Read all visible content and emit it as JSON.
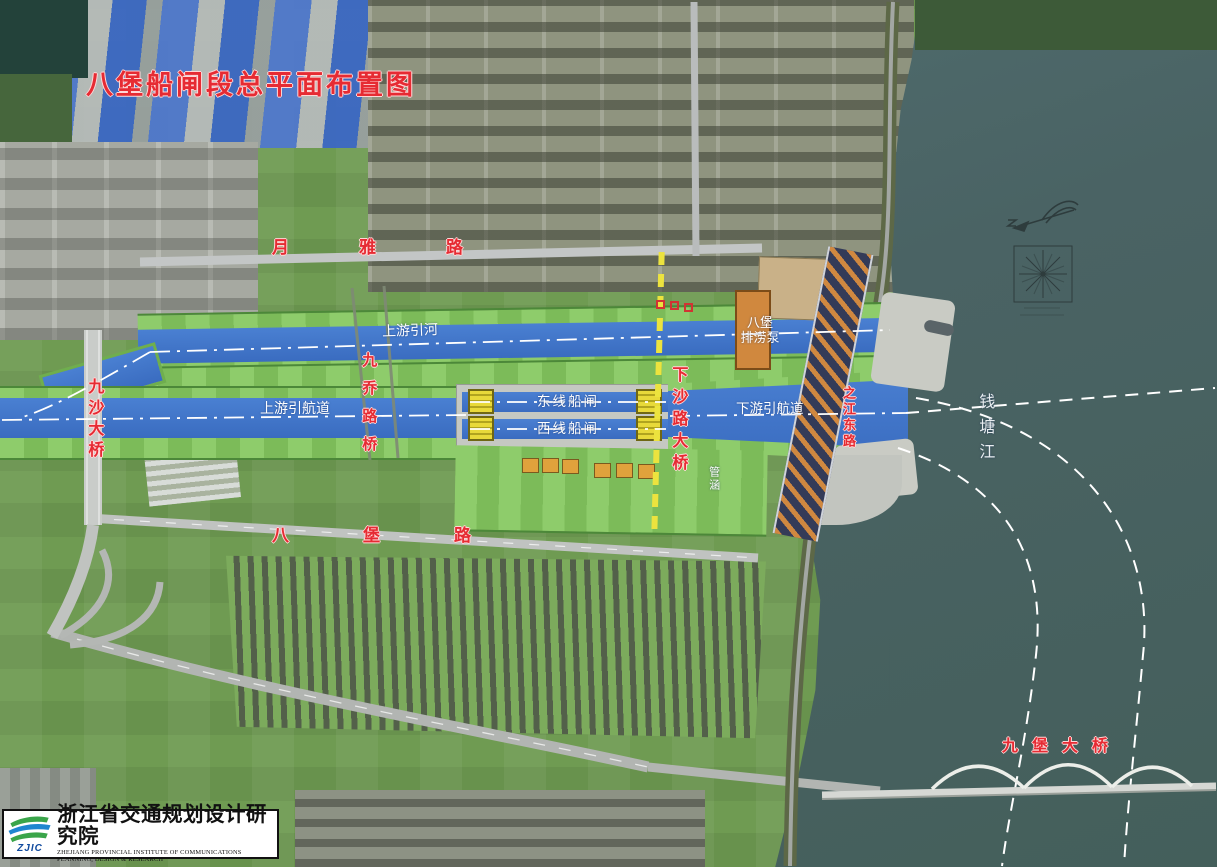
{
  "title": "八堡船闸段总平面布置图",
  "map_labels": {
    "yueya_road": "月雅路",
    "jiusha_bridge": "九沙大桥",
    "jiuqiao_bridge": "九乔路桥",
    "upstream_river": "上游引河",
    "upstream_channel": "上游引航道",
    "east_lock": "东线船闸",
    "west_lock": "西线船闸",
    "xiasha_bridge": "下沙路大桥",
    "downstream_channel": "下游引航道",
    "pump_station_line1": "八堡",
    "pump_station_line2": "排涝泵",
    "culvert": "管涵",
    "zhijiang_east_road": "之江东路",
    "qiantang_river": "钱塘江",
    "babu_road": "八堡路",
    "jiubao_bridge": "九堡大桥"
  },
  "logo": {
    "acronym": "ZJIC",
    "name_zh": "浙江省交通规划设计研究院",
    "name_en": "ZHEJIANG PROVINCIAL INSTITUTE OF COMMUNICATIONS PLANNING, DESIGN & RESEARCH"
  },
  "colors": {
    "label_red": "#e62b33",
    "canal_blue": "#3f74c9",
    "bank_green": "#85c461",
    "river_teal": "#4d6566",
    "gate_yellow": "#e8d93a",
    "pump_orange": "#d0883e"
  }
}
